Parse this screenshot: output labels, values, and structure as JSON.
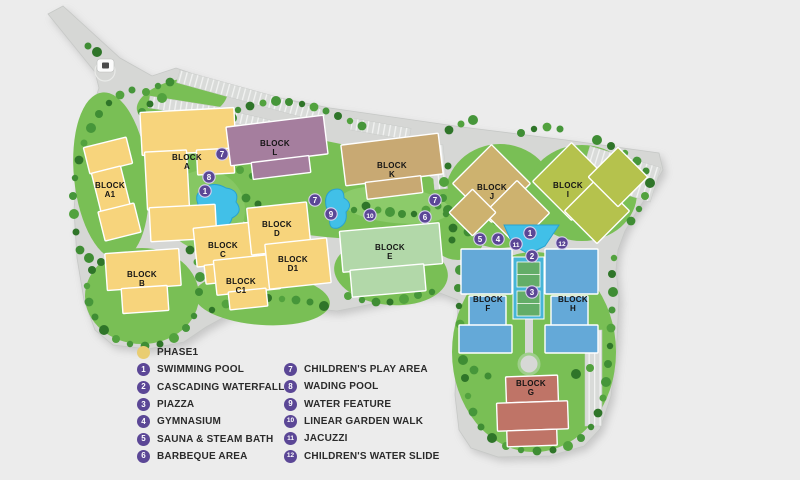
{
  "map": {
    "colors": {
      "marker": "#5b4796",
      "pool": "#41c0e8",
      "pool_edge": "#29a2cf",
      "deck": "#46b5d7",
      "court": "#63ad68",
      "green": "#79bf55",
      "road": "#d6d7d5"
    },
    "blocks": [
      {
        "id": "A",
        "line1": "BLOCK",
        "line2": "A",
        "color": "#f7d47c",
        "lx": 187,
        "ly": 160
      },
      {
        "id": "A1",
        "line1": "BLOCK",
        "line2": "A1",
        "color": "#f7d47c",
        "lx": 110,
        "ly": 188
      },
      {
        "id": "B",
        "line1": "BLOCK",
        "line2": "B",
        "color": "#f7d47c",
        "lx": 142,
        "ly": 277
      },
      {
        "id": "C",
        "line1": "BLOCK",
        "line2": "C",
        "color": "#f7d47c",
        "lx": 223,
        "ly": 248
      },
      {
        "id": "C1",
        "line1": "BLOCK",
        "line2": "C1",
        "color": "#f7d47c",
        "lx": 241,
        "ly": 284
      },
      {
        "id": "D",
        "line1": "BLOCK",
        "line2": "D",
        "color": "#f7d47c",
        "lx": 277,
        "ly": 227
      },
      {
        "id": "D1",
        "line1": "BLOCK",
        "line2": "D1",
        "color": "#f7d47c",
        "lx": 293,
        "ly": 262
      },
      {
        "id": "E",
        "line1": "BLOCK",
        "line2": "E",
        "color": "#b2d8a9",
        "lx": 390,
        "ly": 250
      },
      {
        "id": "F",
        "line1": "BLOCK",
        "line2": "F",
        "color": "#64a9d8",
        "lx": 488,
        "ly": 302
      },
      {
        "id": "G",
        "line1": "BLOCK",
        "line2": "G",
        "color": "#bf7467",
        "lx": 531,
        "ly": 386
      },
      {
        "id": "H",
        "line1": "BLOCK",
        "line2": "H",
        "color": "#64a9d8",
        "lx": 573,
        "ly": 302
      },
      {
        "id": "I",
        "line1": "BLOCK",
        "line2": "I",
        "color": "#b5c24d",
        "lx": 568,
        "ly": 188
      },
      {
        "id": "J",
        "line1": "BLOCK",
        "line2": "J",
        "color": "#cdb26f",
        "lx": 492,
        "ly": 190
      },
      {
        "id": "K",
        "line1": "BLOCK",
        "line2": "K",
        "color": "#c8a973",
        "lx": 392,
        "ly": 168
      },
      {
        "id": "L",
        "line1": "BLOCK",
        "line2": "L",
        "color": "#a57e9e",
        "lx": 275,
        "ly": 146
      }
    ],
    "markers": [
      {
        "n": "7",
        "x": 222,
        "y": 154
      },
      {
        "n": "8",
        "x": 209,
        "y": 177
      },
      {
        "n": "1",
        "x": 205,
        "y": 191
      },
      {
        "n": "7",
        "x": 315,
        "y": 200
      },
      {
        "n": "9",
        "x": 331,
        "y": 214
      },
      {
        "n": "10",
        "x": 370,
        "y": 215
      },
      {
        "n": "7",
        "x": 435,
        "y": 200
      },
      {
        "n": "6",
        "x": 425,
        "y": 217
      },
      {
        "n": "5",
        "x": 480,
        "y": 239
      },
      {
        "n": "4",
        "x": 498,
        "y": 239
      },
      {
        "n": "11",
        "x": 516,
        "y": 244
      },
      {
        "n": "1",
        "x": 530,
        "y": 233
      },
      {
        "n": "2",
        "x": 532,
        "y": 256
      },
      {
        "n": "12",
        "x": 562,
        "y": 243
      },
      {
        "n": "3",
        "x": 532,
        "y": 292
      }
    ]
  },
  "legend": {
    "phase_label": "PHASE1",
    "phase_color": "#e9cd72",
    "columns": [
      [
        {
          "n": "1",
          "label": "SWIMMING POOL"
        },
        {
          "n": "2",
          "label": "CASCADING WATERFALL"
        },
        {
          "n": "3",
          "label": "PIAZZA"
        },
        {
          "n": "4",
          "label": "GYMNASIUM"
        },
        {
          "n": "5",
          "label": "SAUNA & STEAM BATH"
        },
        {
          "n": "6",
          "label": "BARBEQUE AREA"
        }
      ],
      [
        {
          "n": "7",
          "label": "CHILDREN'S PLAY AREA"
        },
        {
          "n": "8",
          "label": "WADING POOL"
        },
        {
          "n": "9",
          "label": "WATER FEATURE"
        },
        {
          "n": "10",
          "label": "LINEAR GARDEN WALK"
        },
        {
          "n": "11",
          "label": "JACUZZI"
        },
        {
          "n": "12",
          "label": "CHILDREN'S WATER SLIDE"
        }
      ]
    ]
  }
}
